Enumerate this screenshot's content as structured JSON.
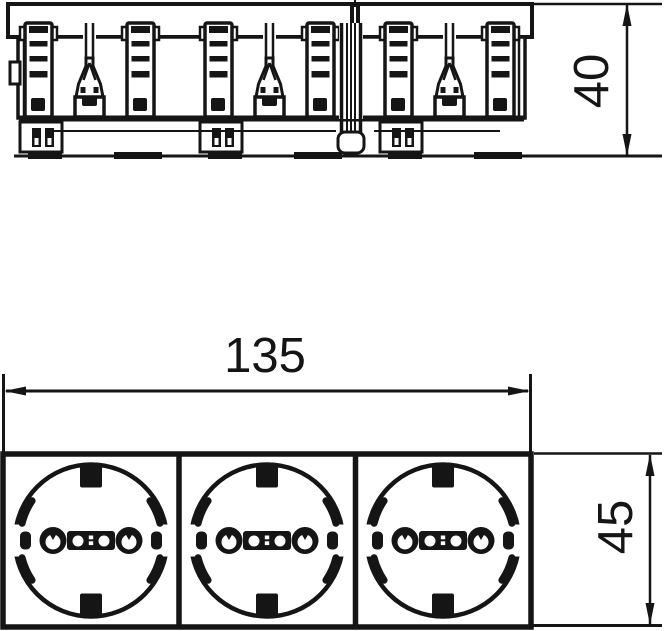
{
  "page": {
    "background": "#ffffff",
    "line_color": "#151515"
  },
  "drawing": {
    "kind": "technical-dimension-drawing",
    "views": {
      "top_view": {
        "name": "side-section-view",
        "module_count": 3
      },
      "front_view": {
        "name": "front-view",
        "socket_count": 3
      }
    },
    "dimensions": {
      "depth": {
        "label": "40",
        "orientation": "vertical",
        "view": "top_view"
      },
      "width": {
        "label": "135",
        "orientation": "horizontal",
        "view": "front_view"
      },
      "height": {
        "label": "45",
        "orientation": "vertical",
        "view": "front_view"
      }
    }
  }
}
